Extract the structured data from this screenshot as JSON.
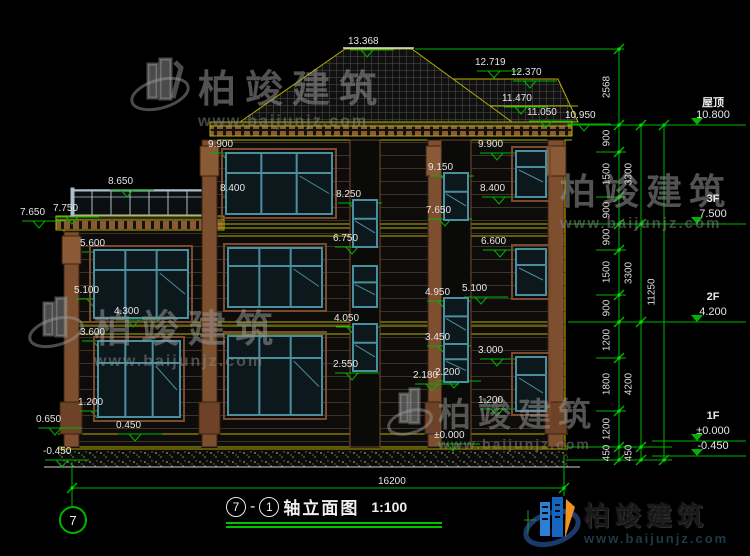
{
  "drawing": {
    "title": {
      "axis_from": "7",
      "joiner": "-",
      "axis_to": "1",
      "name": "轴立面图",
      "scale": "1:100"
    },
    "axis_bubble": "7",
    "bottom_dim": {
      "text": "16200",
      "x": 378,
      "y": 476,
      "x1": 72,
      "x2": 564,
      "line_y": 488
    }
  },
  "annotations": [
    {
      "t": "13.368",
      "x": 350,
      "y": 50
    },
    {
      "t": "12.719",
      "x": 477,
      "y": 71
    },
    {
      "t": "12.370",
      "x": 513,
      "y": 81
    },
    {
      "t": "11.470",
      "x": 504,
      "y": 107
    },
    {
      "t": "11.050",
      "x": 529,
      "y": 121
    },
    {
      "t": "10.950",
      "x": 567,
      "y": 124
    },
    {
      "t": "9.900",
      "x": 210,
      "y": 153
    },
    {
      "t": "8.400",
      "x": 222,
      "y": 197
    },
    {
      "t": "9.900",
      "x": 480,
      "y": 153
    },
    {
      "t": "8.400",
      "x": 482,
      "y": 197
    },
    {
      "t": "9.150",
      "x": 430,
      "y": 176
    },
    {
      "t": "7.650",
      "x": 428,
      "y": 219
    },
    {
      "t": "8.650",
      "x": 110,
      "y": 190
    },
    {
      "t": "7.650",
      "x": 22,
      "y": 221
    },
    {
      "t": "7.750",
      "x": 55,
      "y": 217
    },
    {
      "t": "8.250",
      "x": 338,
      "y": 203
    },
    {
      "t": "6.750",
      "x": 335,
      "y": 247
    },
    {
      "t": "6.600",
      "x": 483,
      "y": 250
    },
    {
      "t": "5.600",
      "x": 82,
      "y": 252
    },
    {
      "t": "5.100",
      "x": 76,
      "y": 299
    },
    {
      "t": "4.300",
      "x": 116,
      "y": 320
    },
    {
      "t": "3.600",
      "x": 82,
      "y": 341
    },
    {
      "t": "5.100",
      "x": 464,
      "y": 297
    },
    {
      "t": "4.950",
      "x": 427,
      "y": 301
    },
    {
      "t": "4.050",
      "x": 336,
      "y": 327
    },
    {
      "t": "3.450",
      "x": 427,
      "y": 346
    },
    {
      "t": "3.000",
      "x": 480,
      "y": 359
    },
    {
      "t": "2.550",
      "x": 335,
      "y": 373
    },
    {
      "t": "2.180",
      "x": 415,
      "y": 384
    },
    {
      "t": "2.200",
      "x": 437,
      "y": 381
    },
    {
      "t": "1.200",
      "x": 80,
      "y": 411
    },
    {
      "t": "0.650",
      "x": 38,
      "y": 428
    },
    {
      "t": "0.450",
      "x": 118,
      "y": 434
    },
    {
      "t": "-0.450",
      "x": 45,
      "y": 460
    },
    {
      "t": "1.200",
      "x": 480,
      "y": 409
    },
    {
      "t": "±0.000",
      "x": 436,
      "y": 444
    }
  ],
  "levels": [
    {
      "name": "屋顶",
      "elev": "10.800",
      "y": 125
    },
    {
      "name": "3F",
      "elev": "7.500",
      "y": 224
    },
    {
      "name": "2F",
      "elev": "4.200",
      "y": 322
    },
    {
      "name": "1F",
      "elev": "±0.000",
      "y": 441
    },
    {
      "name": "",
      "elev": "-0.450",
      "y": 456
    }
  ],
  "dims": {
    "lines": [
      {
        "x": 619,
        "ticks": [
          49,
          125,
          152,
          197,
          224,
          250,
          295,
          322,
          358,
          411,
          447,
          460
        ],
        "labels": [
          {
            "t": "2568",
            "y": 87
          },
          {
            "t": "900",
            "y": 138
          },
          {
            "t": "1500",
            "y": 174
          },
          {
            "t": "900",
            "y": 210
          },
          {
            "t": "900",
            "y": 237
          },
          {
            "t": "1500",
            "y": 272
          },
          {
            "t": "900",
            "y": 308
          },
          {
            "t": "1200",
            "y": 340
          },
          {
            "t": "1800",
            "y": 384
          },
          {
            "t": "1200",
            "y": 429
          },
          {
            "t": "450",
            "y": 453
          }
        ]
      },
      {
        "x": 641,
        "ticks": [
          125,
          224,
          322,
          447,
          460
        ],
        "labels": [
          {
            "t": "3300",
            "y": 174
          },
          {
            "t": "3300",
            "y": 273
          },
          {
            "t": "4200",
            "y": 384
          },
          {
            "t": "450",
            "y": 453
          }
        ]
      },
      {
        "x": 664,
        "ticks": [
          125,
          460
        ],
        "labels": [
          {
            "t": "11250",
            "y": 292
          }
        ]
      }
    ]
  },
  "watermark": {
    "name": "柏竣建筑",
    "url": "www.baijunjz.com"
  },
  "logo": {
    "name": "柏竣建筑",
    "url": "www.baijunjz.com"
  },
  "colors": {
    "dim_green": "#00b400",
    "outline_yellow": "#b5b000",
    "window_teal": "#4a8fa0",
    "trim_brown": "#7a4a2e",
    "text": "#e6e6e6"
  }
}
